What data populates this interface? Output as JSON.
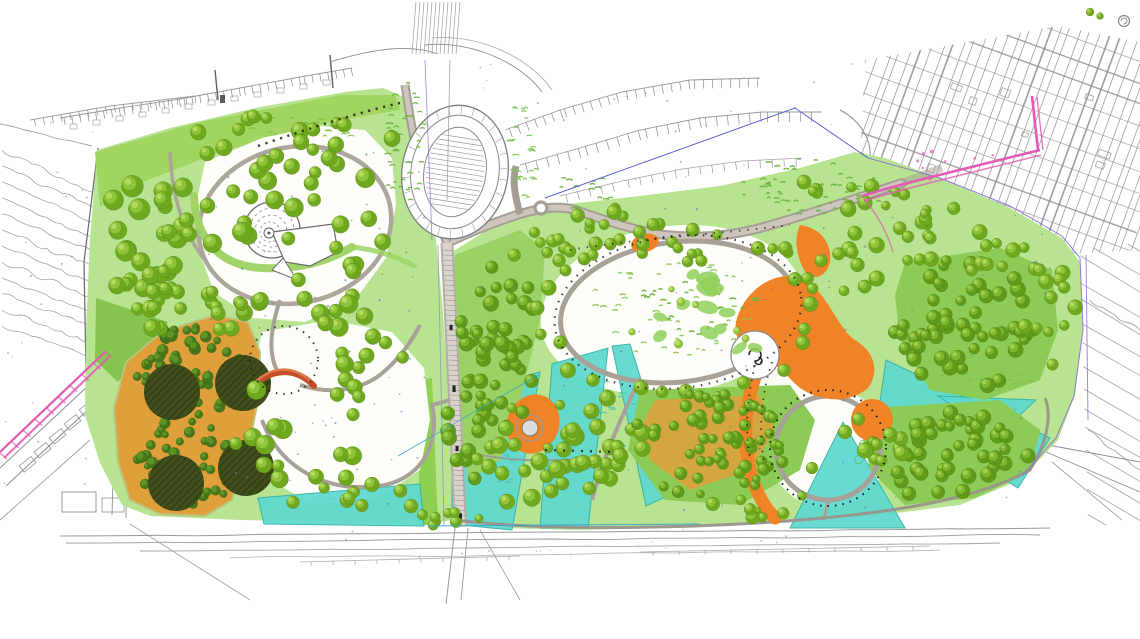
{
  "canvas": {
    "width": 1140,
    "height": 639,
    "background": "#ffffff"
  },
  "colors": {
    "lawn": "#b8e391",
    "lawn_bright": "#9fd35f",
    "lawn_dark": "#85c44e",
    "woodland_ground": "#8ccb55",
    "white_clearing": "#fdfdfa",
    "tree_base": "#6fa81f",
    "tree_mid": "#8ec33a",
    "tree_light": "#b7de66",
    "dense_base": "#5f9a1a",
    "dense_mid": "#7fb62e",
    "dense_light": "#a3d253",
    "orchard_ground": "#dfa03c",
    "orchard_tree_dark": "#47761a",
    "orchard_tree_mid": "#5f9426",
    "grove_fill": "#414e1c",
    "grove_hatch": "#2c3911",
    "orange": "#f08325",
    "orange_dark": "#d96d15",
    "cyan": "#5fd9cf",
    "cyan_edge": "#2fb2a6",
    "magenta": "#e25ab4",
    "red_arch": "#c34e28",
    "red_arch_light": "#e07a4a",
    "road_fill": "#a69e95",
    "road_core": "#cdc6bd",
    "path": "#a8a198",
    "cad": "#8e8e92",
    "cad_dark": "#5e5e64",
    "blue_line": "#5a5fd6",
    "purple_line": "#8a6fd0",
    "teal_line": "#2fa8c8",
    "dash_black": "#1c1c1c",
    "tuft": "#7cc24a",
    "tuft_dark": "#69b13c"
  },
  "features": {
    "names": [
      "spiral-mound",
      "oval-track",
      "orchard-grid",
      "dark-grove-circles",
      "red-arch-bridge",
      "central-avenue-road",
      "east-west-road",
      "meadow-loop-path",
      "orange-play-areas",
      "cyan-water-wedges",
      "woodland-masses",
      "circular-lawn-ring",
      "magenta-survey-route",
      "blue-boundary-line",
      "surrounding-cad-linework"
    ]
  }
}
